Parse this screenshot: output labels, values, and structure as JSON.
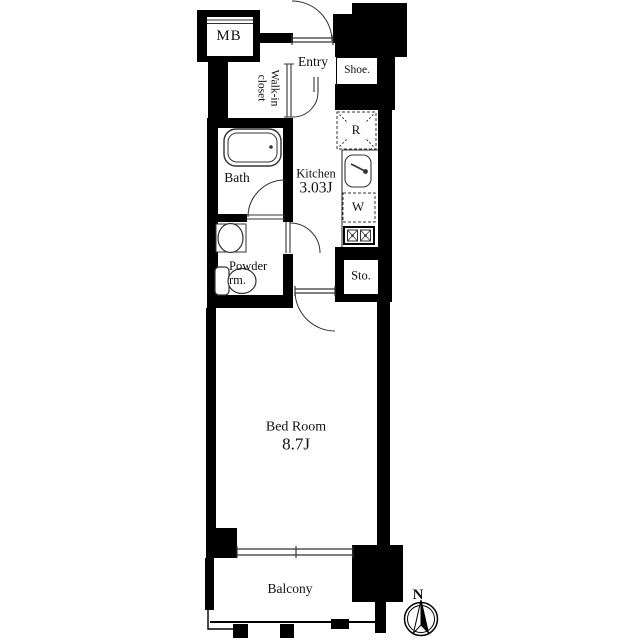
{
  "floorplan": {
    "rooms": {
      "mb": {
        "label": "MB"
      },
      "walk_in_closet": {
        "label_line1": "Walk-in",
        "label_line2": "closet"
      },
      "entry": {
        "label": "Entry"
      },
      "shoe": {
        "label": "Shoe."
      },
      "kitchen": {
        "label": "Kitchen",
        "size": "3.03J"
      },
      "bath": {
        "label": "Bath"
      },
      "powder_room": {
        "label_line1": "Powder",
        "label_line2": "rm."
      },
      "storage": {
        "label": "Sto."
      },
      "bedroom": {
        "label": "Bed Room",
        "size": "8.7J"
      },
      "balcony": {
        "label": "Balcony"
      }
    },
    "appliances": {
      "refrigerator": {
        "label": "R"
      },
      "washer": {
        "label": "W"
      }
    },
    "compass": {
      "north_label": "N"
    },
    "colors": {
      "wall": "#000000",
      "background": "#ffffff",
      "line": "#333333"
    }
  }
}
